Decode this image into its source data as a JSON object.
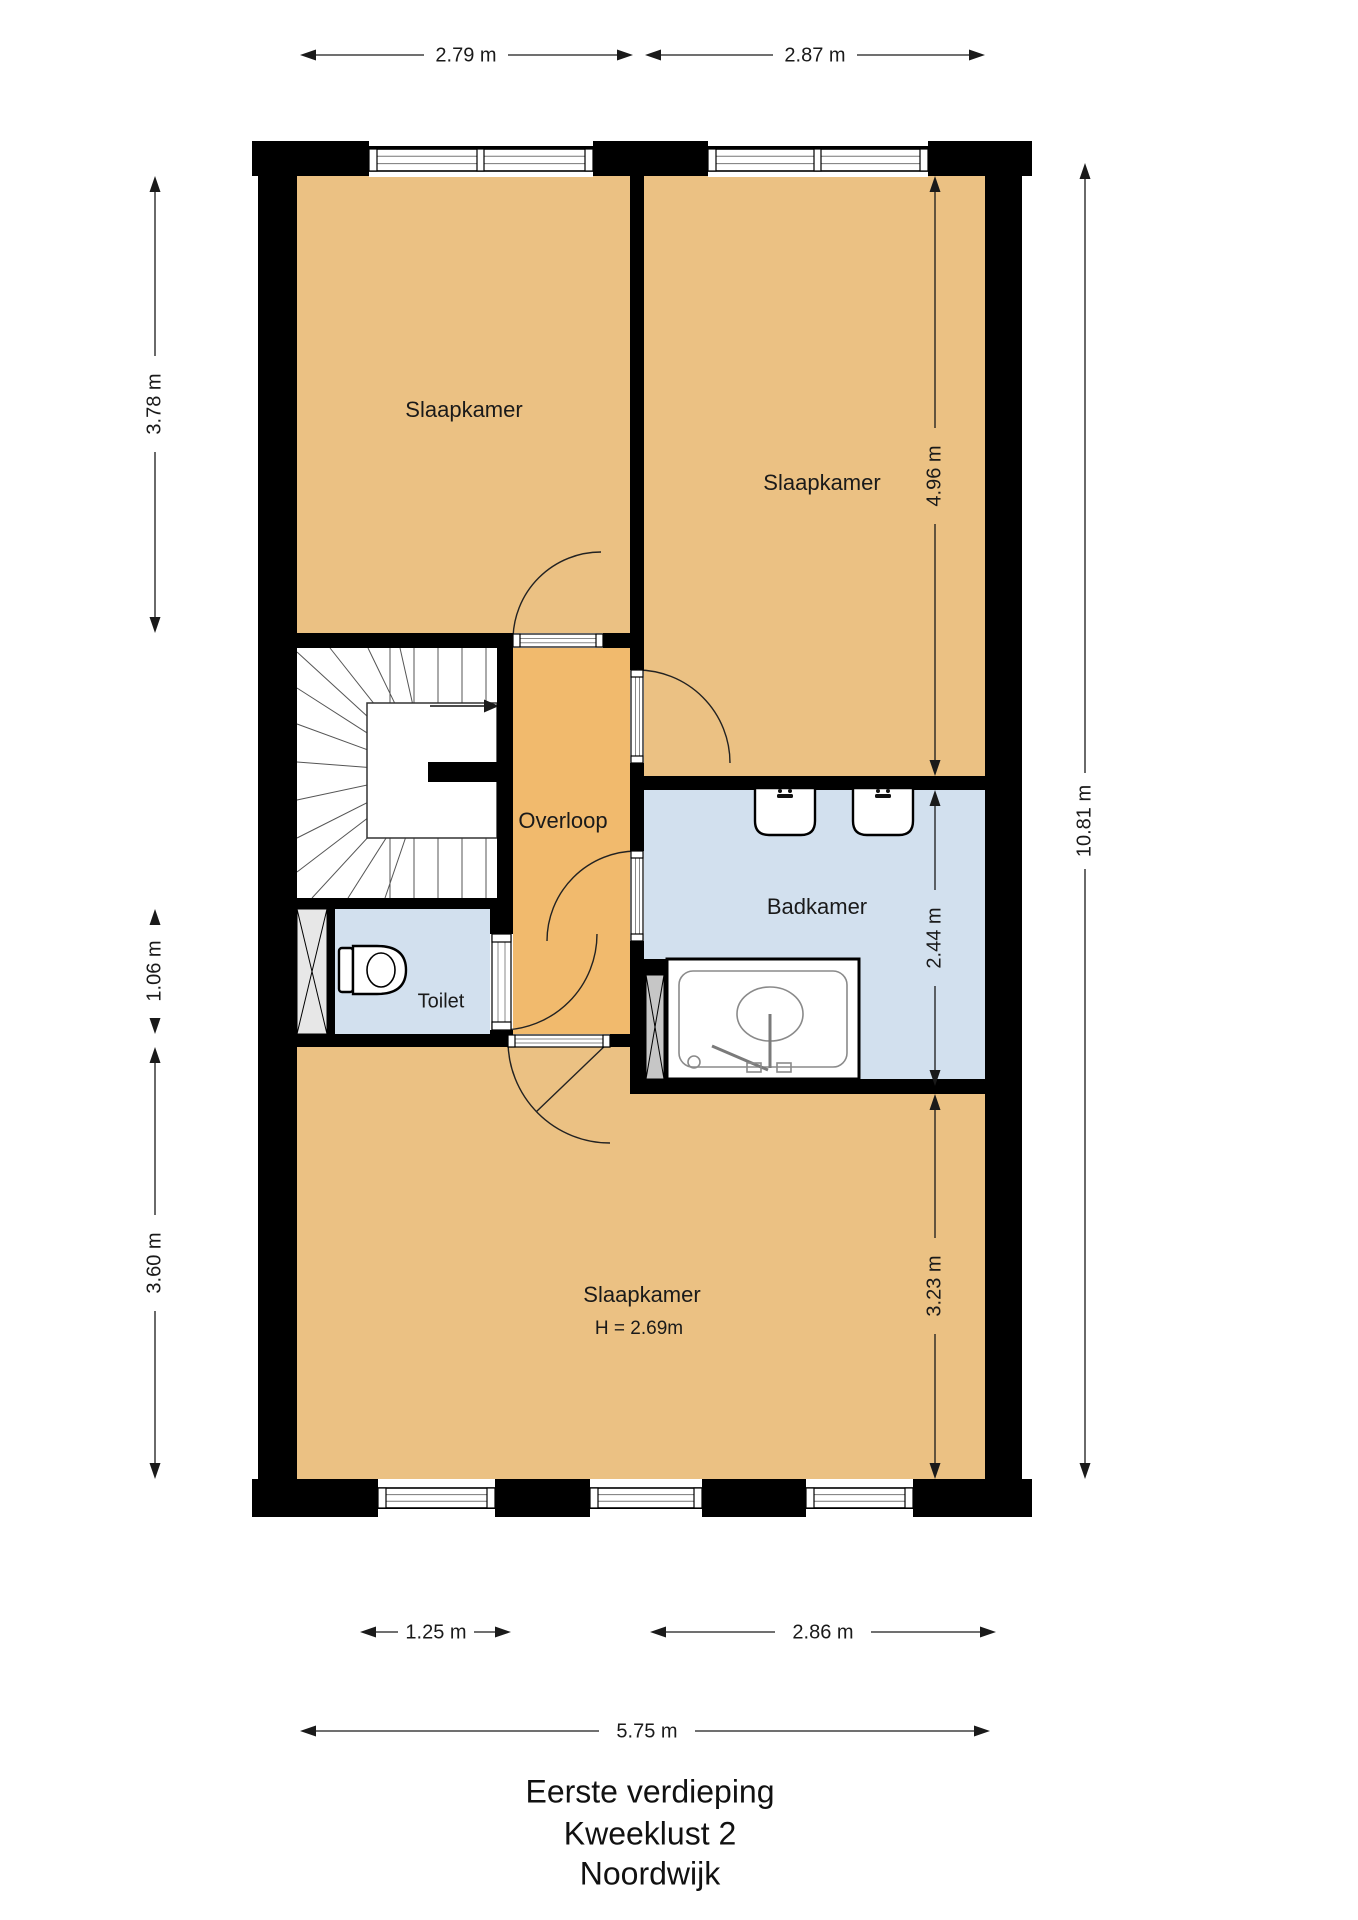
{
  "floorplan": {
    "title": {
      "line1": "Eerste verdieping",
      "line2": "Kweeklust 2",
      "line3": "Noordwijk"
    },
    "rooms": {
      "bedroom_top_left": "Slaapkamer",
      "bedroom_top_right": "Slaapkamer",
      "landing": "Overloop",
      "bathroom": "Badkamer",
      "toilet": "Toilet",
      "bedroom_bottom": "Slaapkamer",
      "bedroom_bottom_ceiling": "H = 2.69m"
    },
    "dimensions": {
      "top_left_width": "2.79 m",
      "top_right_width": "2.87 m",
      "left_upper": "3.78 m",
      "left_toilet": "1.06 m",
      "left_lower": "3.60 m",
      "right_upper": "4.96 m",
      "right_middle": "2.44 m",
      "right_lower": "3.23 m",
      "total_height": "10.81 m",
      "bottom_window": "1.25 m",
      "bottom_right_width": "2.86 m",
      "total_width": "5.75 m"
    },
    "colors": {
      "room": "#ebc183",
      "landing": "#f1ba6d",
      "wet_room": "#d2e0ee",
      "wall": "#000000"
    }
  }
}
